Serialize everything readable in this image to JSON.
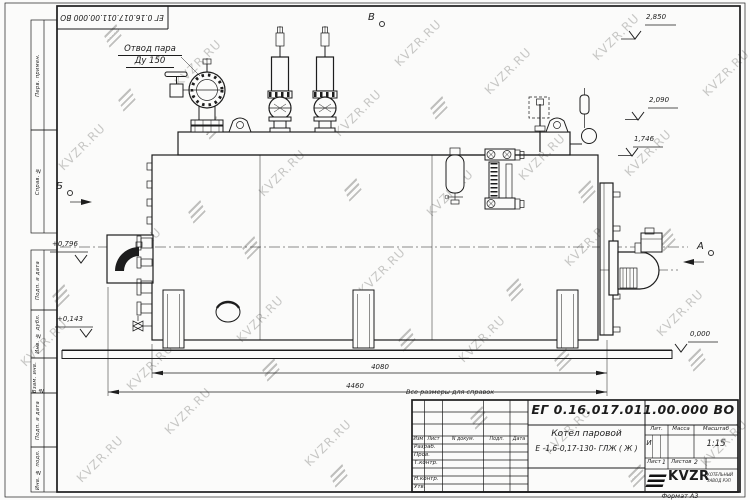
{
  "watermark": {
    "text": "KVZR.RU"
  },
  "frame": {
    "top_stamp": "ЕГ 0.16.017.011.00.000  ВО",
    "side_labels": [
      "Перв. примен.",
      "Справ. №",
      "Подп. и дата",
      "Инв. № дубл.",
      "Взам. инв. №",
      "Подп. и дата",
      "Инв. № подл."
    ]
  },
  "drawing": {
    "callout_steam_1": "Отвод пара",
    "callout_steam_2": "Ду 150",
    "view_b": "Б",
    "view_v": "В",
    "view_a": "А",
    "lvl_2850": "2,850",
    "lvl_2090": "2,090",
    "lvl_1746": "1,746",
    "lvl_0796": "+0,796",
    "lvl_0143": "+0,143",
    "lvl_0000": "0,000",
    "dim_4080": "4080",
    "dim_4460": "4460",
    "ref_note": "Все размеры для справок"
  },
  "title_block": {
    "doc_number": "ЕГ 0.16.017.011.00.000  ВО",
    "col_izm": "Изм",
    "col_list": "Лист",
    "col_ndoc": "N докум.",
    "col_podp": "Подп.",
    "col_data": "Дата",
    "row_razrab": "Разраб.",
    "row_prov": "Пров.",
    "row_tkontr": "Т.контр.",
    "row_nkontr": "Н.контр.",
    "row_utv": "Утв.",
    "name_line1": "Котел паровой",
    "name_line2": "Е -1,6-0,17-130- ГЛЖ ( Ж )",
    "lit_label": "Лит.",
    "mass_label": "Масса",
    "scale_label": "Масштаб",
    "lit_value": "И",
    "scale_value": "1:15",
    "sheet_label": "Лист",
    "sheet_no": "1",
    "sheets_label": "Листов",
    "sheets_total": "2",
    "brand": "KVZR",
    "brand_sub1": "КОТЕЛЬНЫЙ",
    "brand_sub2": "ЗАВОД РЭП",
    "format_label": "Формат А3"
  }
}
